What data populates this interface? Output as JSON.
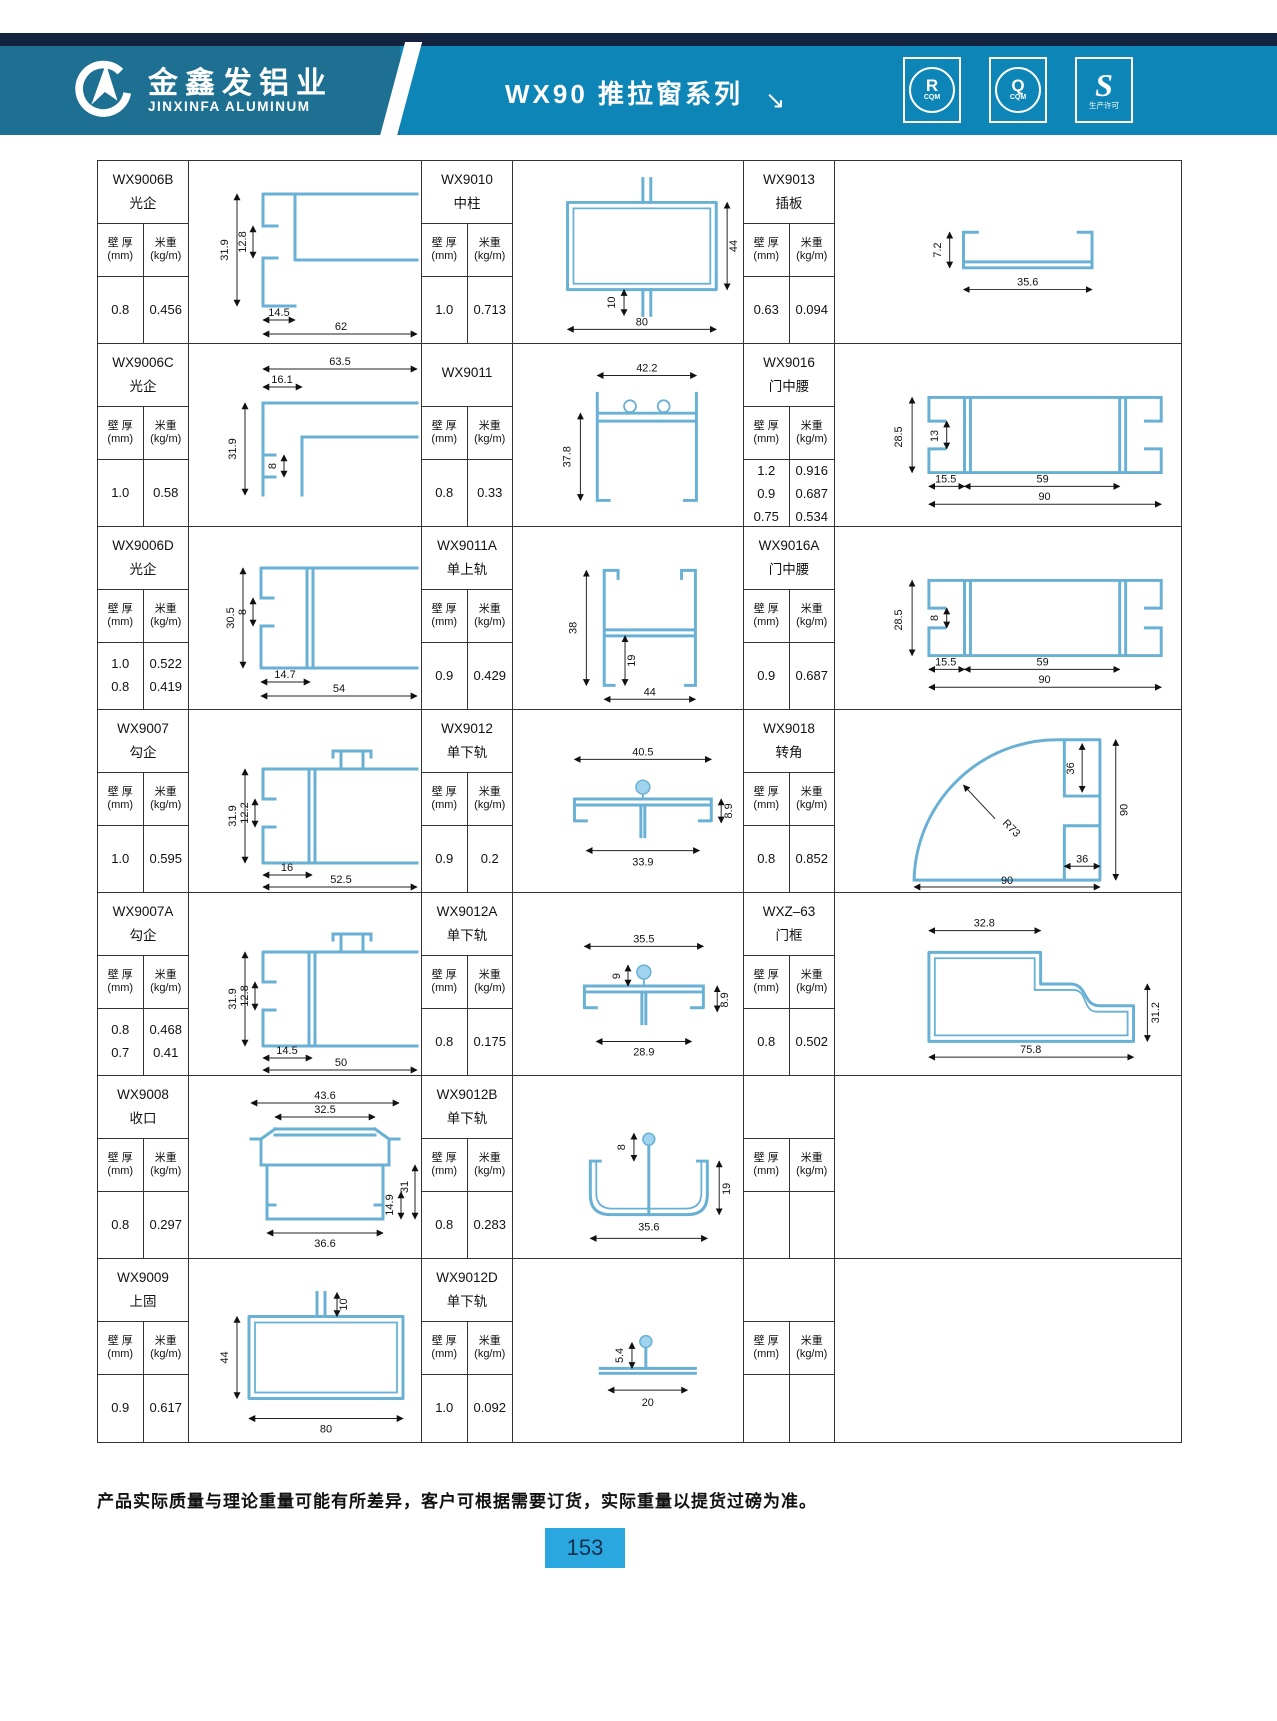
{
  "header": {
    "brand_cn": "金鑫发铝业",
    "brand_en": "JINXINFA ALUMINUM",
    "title": "WX90 推拉窗系列",
    "title_arrow": "↘",
    "badges": [
      {
        "letter": "R",
        "sub": "CQM"
      },
      {
        "letter": "Q",
        "sub": "CQM"
      },
      {
        "letter": "S",
        "sub": "生产许可"
      }
    ]
  },
  "labels": {
    "thickness": "壁 厚",
    "thickness_unit": "(mm)",
    "weight": "米重",
    "weight_unit": "(kg/m)"
  },
  "products": [
    {
      "code": "WX9006B",
      "name": "光企",
      "thickness": "0.8",
      "weight": "0.456",
      "dims": [
        "31.9",
        "12.8",
        "14.5",
        "62"
      ]
    },
    {
      "code": "WX9010",
      "name": "中柱",
      "thickness": "1.0",
      "weight": "0.713",
      "dims": [
        "44",
        "10",
        "80"
      ]
    },
    {
      "code": "WX9013",
      "name": "插板",
      "thickness": "0.63",
      "weight": "0.094",
      "dims": [
        "7.2",
        "35.6"
      ]
    },
    {
      "code": "WX9006C",
      "name": "光企",
      "thickness": "1.0",
      "weight": "0.58",
      "dims": [
        "63.5",
        "16.1",
        "31.9",
        "8"
      ]
    },
    {
      "code": "WX9011",
      "name": "",
      "thickness": "0.8",
      "weight": "0.33",
      "dims": [
        "42.2",
        "37.8"
      ]
    },
    {
      "code": "WX9016",
      "name": "门中腰",
      "thickness": "1.2\n0.9\n0.75",
      "weight": "0.916\n0.687\n0.534",
      "dims": [
        "28.5",
        "13",
        "15.5",
        "59",
        "90"
      ]
    },
    {
      "code": "WX9006D",
      "name": "光企",
      "thickness": "1.0\n0.8",
      "weight": "0.522\n0.419",
      "dims": [
        "30.5",
        "8",
        "14.7",
        "54"
      ]
    },
    {
      "code": "WX9011A",
      "name": "单上轨",
      "thickness": "0.9",
      "weight": "0.429",
      "dims": [
        "38",
        "19",
        "44"
      ]
    },
    {
      "code": "WX9016A",
      "name": "门中腰",
      "thickness": "0.9",
      "weight": "0.687",
      "dims": [
        "28.5",
        "8",
        "15.5",
        "59",
        "90"
      ]
    },
    {
      "code": "WX9007",
      "name": "勾企",
      "thickness": "1.0",
      "weight": "0.595",
      "dims": [
        "31.9",
        "12.2",
        "16",
        "52.5"
      ]
    },
    {
      "code": "WX9012",
      "name": "单下轨",
      "thickness": "0.9",
      "weight": "0.2",
      "dims": [
        "40.5",
        "33.9",
        "8.9"
      ]
    },
    {
      "code": "WX9018",
      "name": "转角",
      "thickness": "0.8",
      "weight": "0.852",
      "dims": [
        "R73",
        "36",
        "90",
        "36",
        "90"
      ]
    },
    {
      "code": "WX9007A",
      "name": "勾企",
      "thickness": "0.8\n0.7",
      "weight": "0.468\n0.41",
      "dims": [
        "31.9",
        "12.8",
        "14.5",
        "50"
      ]
    },
    {
      "code": "WX9012A",
      "name": "单下轨",
      "thickness": "0.8",
      "weight": "0.175",
      "dims": [
        "35.5",
        "9",
        "28.9",
        "8.9"
      ]
    },
    {
      "code": "WXZ–63",
      "name": "门框",
      "thickness": "0.8",
      "weight": "0.502",
      "dims": [
        "32.8",
        "31.2",
        "75.8"
      ]
    },
    {
      "code": "WX9008",
      "name": "收口",
      "thickness": "0.8",
      "weight": "0.297",
      "dims": [
        "43.6",
        "32.5",
        "36.6",
        "14.9",
        "31"
      ]
    },
    {
      "code": "WX9012B",
      "name": "单下轨",
      "thickness": "0.8",
      "weight": "0.283",
      "dims": [
        "8",
        "35.6",
        "19"
      ]
    },
    {
      "code": "",
      "name": "",
      "thickness": "",
      "weight": "",
      "dims": []
    },
    {
      "code": "WX9009",
      "name": "上固",
      "thickness": "0.9",
      "weight": "0.617",
      "dims": [
        "10",
        "44",
        "80"
      ]
    },
    {
      "code": "WX9012D",
      "name": "单下轨",
      "thickness": "1.0",
      "weight": "0.092",
      "dims": [
        "5.4",
        "20"
      ]
    },
    {
      "code": "",
      "name": "",
      "thickness": "",
      "weight": "",
      "dims": []
    }
  ],
  "footer": {
    "note": "产品实际质量与理论重量可能有所差异，客户可根据需要订货，实际重量以提货过磅为准。",
    "page": "153"
  },
  "colors": {
    "top_strip": "#14233f",
    "header_left": "#1e7093",
    "header_right": "#0d85b7",
    "page_badge": "#2ba7e0",
    "profile_stroke": "#69b0d5"
  }
}
